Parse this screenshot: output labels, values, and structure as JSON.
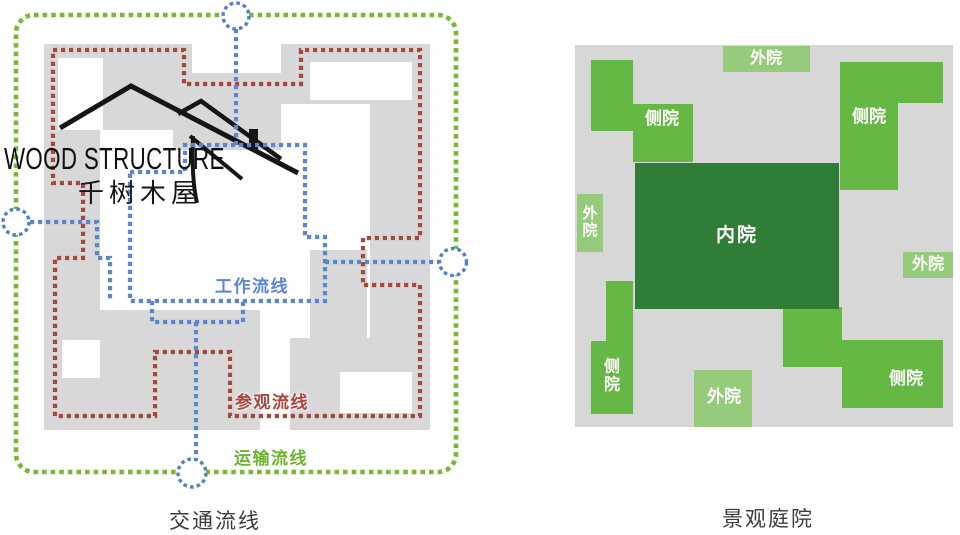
{
  "left_panel": {
    "caption": "交通流线",
    "logo": {
      "line1": "WOOD STRUCTURE",
      "line2": "千树木屋"
    },
    "legend": {
      "work": {
        "label": "工作流线",
        "color": "#5b86d0"
      },
      "visit": {
        "label": "参观流线",
        "color": "#a8473f"
      },
      "transport": {
        "label": "运输流线",
        "color": "#6cb52f"
      }
    },
    "colors": {
      "footprint": "#d8d8d8",
      "transport_loop": "#77b834",
      "visit_loop": "#a8473f",
      "work_loop": "#5b86d0",
      "entry_circle": "#4f7fd0"
    }
  },
  "right_panel": {
    "caption": "景观庭院",
    "labels": {
      "outer_top": "外院",
      "side_top_left": "侧院",
      "side_top_right": "侧院",
      "outer_left": "外院",
      "inner": "内院",
      "outer_right": "外院",
      "side_bottom_left": "侧院",
      "outer_bottom": "外院",
      "side_bottom_right": "侧院"
    },
    "colors": {
      "ground": "#d7d7d7",
      "outer_yard": "#96cb7b",
      "side_yard": "#64b843",
      "inner_yard": "#2f7d36"
    }
  }
}
